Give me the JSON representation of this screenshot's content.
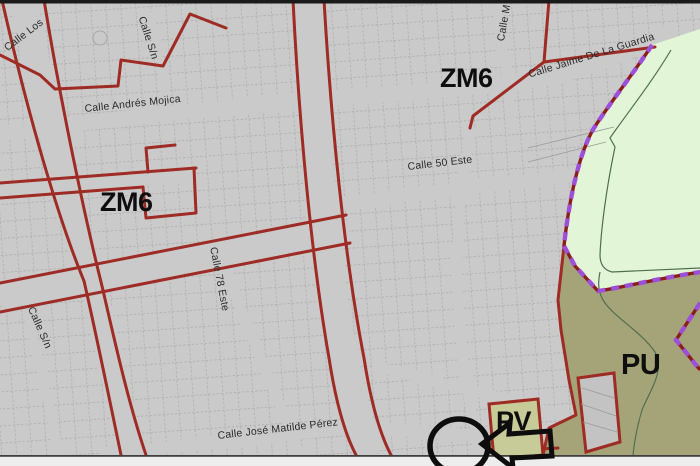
{
  "map": {
    "type": "zoning-map",
    "zone_labels": [
      {
        "id": "zm6-left",
        "text": "ZM6"
      },
      {
        "id": "zm6-right",
        "text": "ZM6"
      },
      {
        "id": "pu",
        "text": "PU"
      },
      {
        "id": "pv",
        "text": "PV"
      }
    ],
    "street_labels": [
      {
        "id": "calle-los",
        "text": "Calle Los"
      },
      {
        "id": "calle-sn-top",
        "text": "Calle S/n"
      },
      {
        "id": "calle-m",
        "text": "Calle M"
      },
      {
        "id": "calle-andres-mojica",
        "text": "Calle Andrés Mojica"
      },
      {
        "id": "calle-jaime-de-la-guardia",
        "text": "Calle Jaime De La Guardia"
      },
      {
        "id": "calle-50-este",
        "text": "Calle 50 Este"
      },
      {
        "id": "calle-78-este",
        "text": "Calle 78 Este"
      },
      {
        "id": "calle-sn-bottom",
        "text": "Calle S/n"
      },
      {
        "id": "calle-jose-matilde-perez",
        "text": "Calle José Matilde Pérez"
      }
    ],
    "icons": {
      "highlight_circle": "circle-outline-annotation",
      "pointer_arrow": "arrow-left-annotation"
    },
    "colors": {
      "map_background": "#cacaca",
      "parcel_line": "#a6a6a6",
      "zone_boundary_red": "#9e2b24",
      "protection_boundary_purple": "#9c50d8",
      "protection_boundary_underlay": "#8a1d1d",
      "green_area": "#e2f5d7",
      "olive_area": "#a5a478",
      "pv_parcel": "#c6cb97",
      "stream_line": "#4f6f4f",
      "annotation_black": "#0d0d0d"
    }
  }
}
